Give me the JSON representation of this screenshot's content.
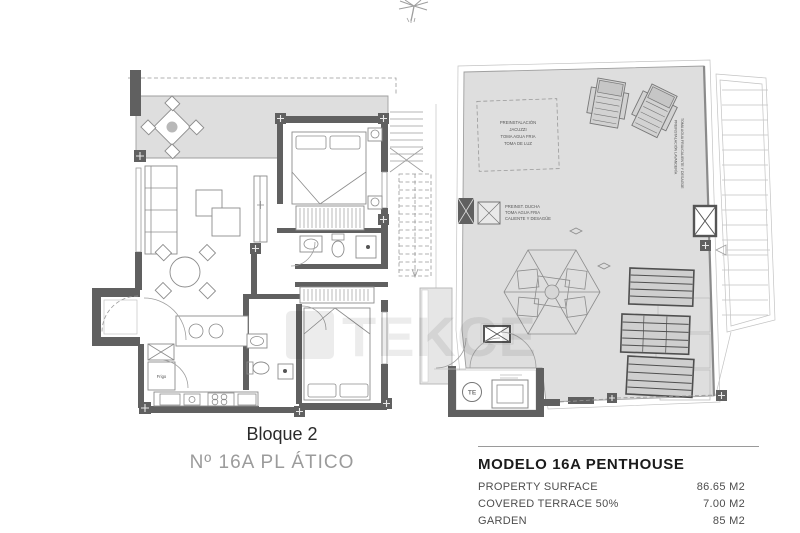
{
  "watermark": {
    "text": "TEKCE"
  },
  "left_plan": {
    "caption": "Bloque 2",
    "subcaption": "Nº 16A PL ÁTICO",
    "labels": {
      "fridge": "Frigo"
    }
  },
  "right_plan": {
    "jacuzzi_note": [
      "PREINSTALACIÓN",
      "JACUZZI",
      "TOMA AGUA FRIA",
      "TOMA DE LUZ"
    ],
    "shower_note": [
      "PREINST. DUCHA",
      "TOMA AGUA FRIA",
      "CALIENTE Y DESAGÜE"
    ],
    "laundry_note": [
      "TOMA AGUA FRIA/CALIENTE Y DESAGÜE",
      "PREINSTALACIÓN LAVANDERÍA"
    ],
    "boiler_label": "TE"
  },
  "details": {
    "title": "MODELO 16A PENTHOUSE",
    "rows": [
      {
        "label": "PROPERTY SURFACE",
        "value": "86.65 M2"
      },
      {
        "label": "COVERED TERRACE 50%",
        "value": "7.00 M2"
      },
      {
        "label": "GARDEN",
        "value": "85 M2"
      }
    ]
  },
  "colors": {
    "wall": "#606060",
    "terrace_fill": "#dedede",
    "outline": "#9a9a9a",
    "title_text": "#1b1b1b",
    "caption_gray": "#9b9b9b"
  }
}
